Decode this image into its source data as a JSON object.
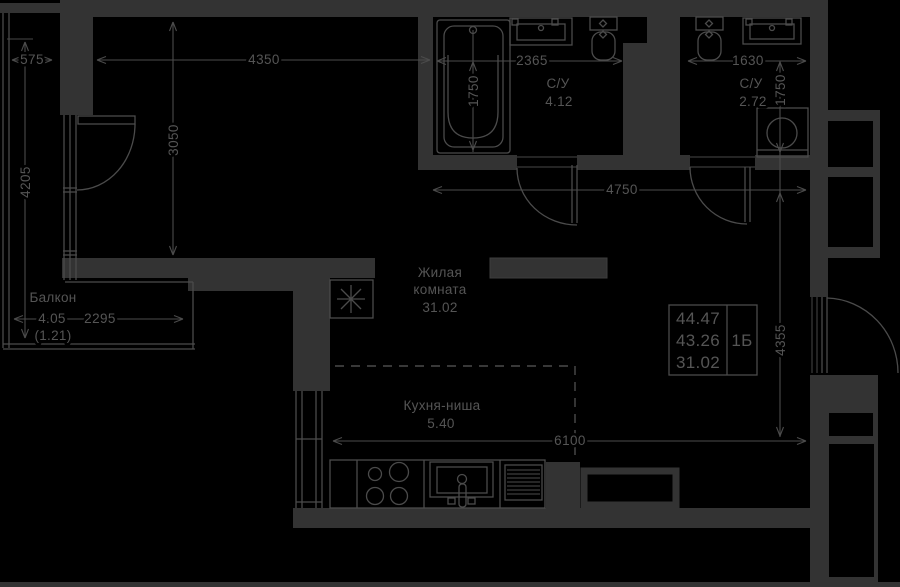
{
  "colors": {
    "background": "#000000",
    "wall": "#333333",
    "line": "#4b4b4b",
    "text": "#555555"
  },
  "balcony": {
    "name": "Балкон",
    "area": "4.05",
    "reduced_area": "(1.21)"
  },
  "living_room": {
    "name_line1": "Жилая",
    "name_line2": "комната",
    "area": "31.02"
  },
  "kitchen": {
    "name": "Кухня-ниша",
    "area": "5.40"
  },
  "bathroom_1": {
    "name": "С/У",
    "area": "4.12"
  },
  "bathroom_2": {
    "name": "С/У",
    "area": "2.72"
  },
  "dimensions_mm": {
    "balcony_depth": "575",
    "living_width": "4350",
    "bath1_width": "2365",
    "bath2_width": "1630",
    "bath1_depth": "1750",
    "bath2_depth": "1750",
    "living_depth": "3050",
    "balcony_length": "4205",
    "hall_width": "4750",
    "right_span": "4355",
    "bottom_span": "6100",
    "balcony_width": "2295"
  },
  "info_box": {
    "value_top": "44.47",
    "value_middle": "43.26",
    "value_bottom": "31.02",
    "unit_type": "1Б"
  }
}
